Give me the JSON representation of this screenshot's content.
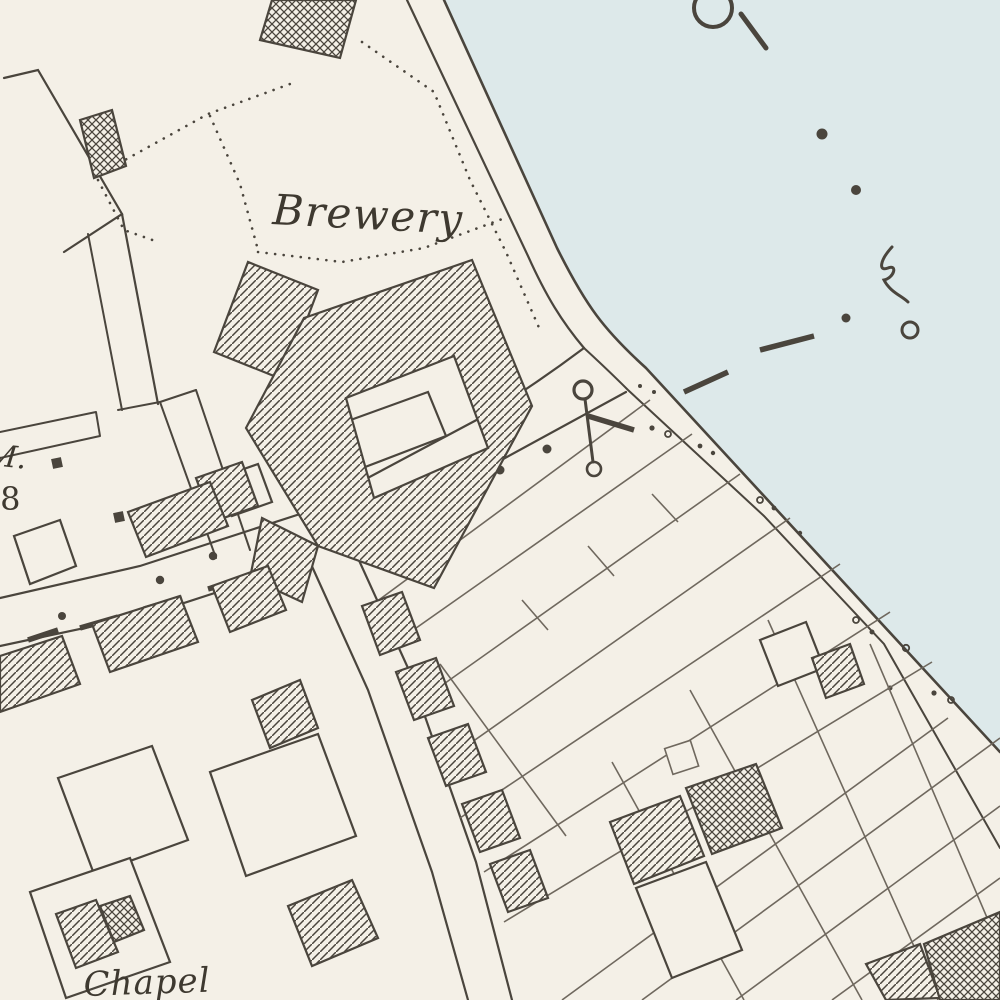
{
  "map": {
    "labels": {
      "brewery": "Brewery",
      "bench_mark_abbrev": "M.",
      "bench_mark_value": "·8",
      "chapel": "Chapel"
    },
    "colors": {
      "paper": "#f4f0e7",
      "water": "#dde9ea",
      "ink": "#4a453d",
      "ink_light": "#6f685e",
      "text": "#3e3930"
    },
    "symbols": {
      "mooring-ring": "circle-with-tail-stroke",
      "flagstaff": "circle-pole-circle",
      "boundary-mark": "thick-dash-segments",
      "shore-stones": "scattered-dots-and-rings",
      "building-fill-hatched": "diagonal-hatch",
      "building-fill-glazed": "cross-hatch"
    }
  }
}
